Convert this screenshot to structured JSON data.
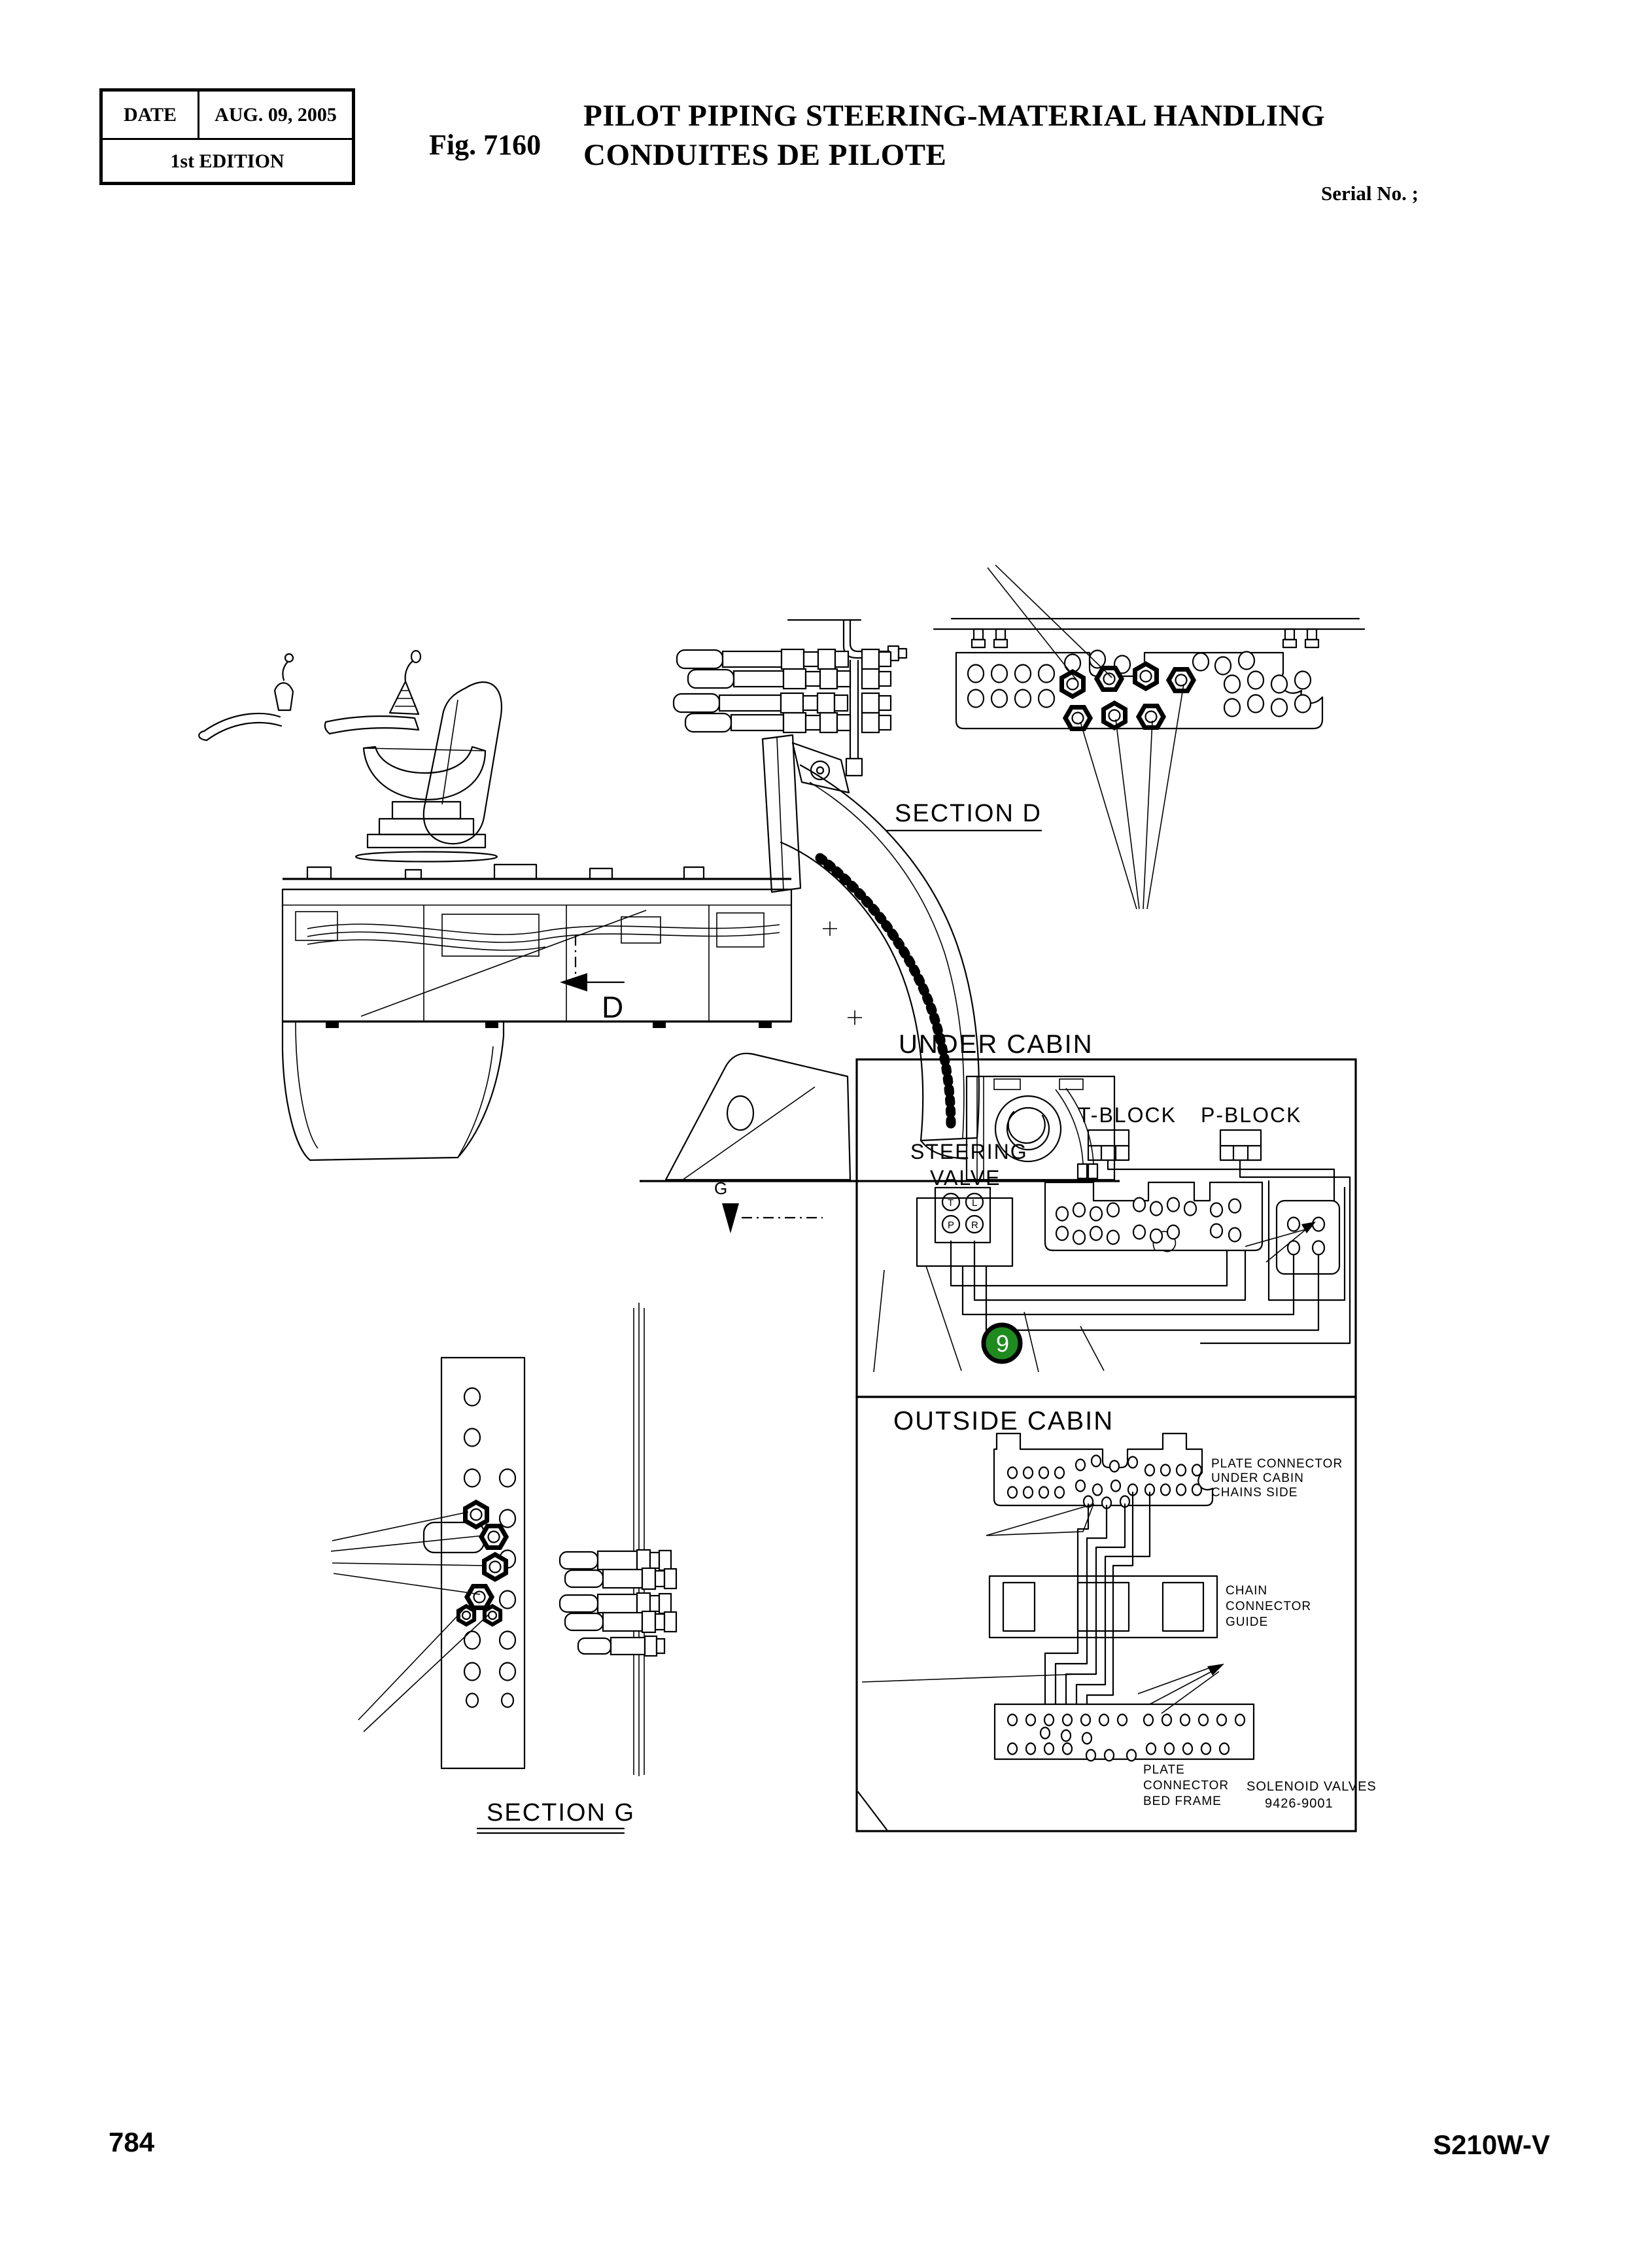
{
  "header": {
    "date_label": "DATE",
    "date_value": "AUG. 09, 2005",
    "edition": "1st EDITION",
    "fig": "Fig. 7160",
    "title1": "PILOT  PIPING STEERING-MATERIAL HANDLING",
    "title2": "CONDUITES DE PILOTE",
    "serial": "Serial No. ;"
  },
  "labels": {
    "section_d": "SECTION  D",
    "section_g": "SECTION  G",
    "d_marker": "D",
    "g_marker": "G"
  },
  "under_cabin": {
    "title": "UNDER CABIN",
    "t_block": "T-BLOCK",
    "p_block": "P-BLOCK",
    "steering1": "STEERING",
    "steering2": "VALVE",
    "port_t": "T",
    "port_l": "L",
    "port_p": "P",
    "port_r": "R",
    "balloon": "9"
  },
  "outside_cabin": {
    "title": "OUTSIDE CABIN",
    "plate_connector_label": [
      "PLATE CONNECTOR",
      "UNDER CABIN",
      "CHAINS SIDE"
    ],
    "chain_guide_label": [
      "CHAIN",
      "CONNECTOR",
      "GUIDE"
    ],
    "bed_frame_label": [
      "PLATE",
      "CONNECTOR",
      "BED FRAME"
    ],
    "solenoid_label": [
      "SOLENOID VALVES",
      "9426-9001"
    ]
  },
  "footer": {
    "page_number": "784",
    "model": "S210W-V"
  },
  "colors": {
    "line": "#000000",
    "balloon_green": "#1f8b1f",
    "balloon_text": "#ffffff"
  }
}
